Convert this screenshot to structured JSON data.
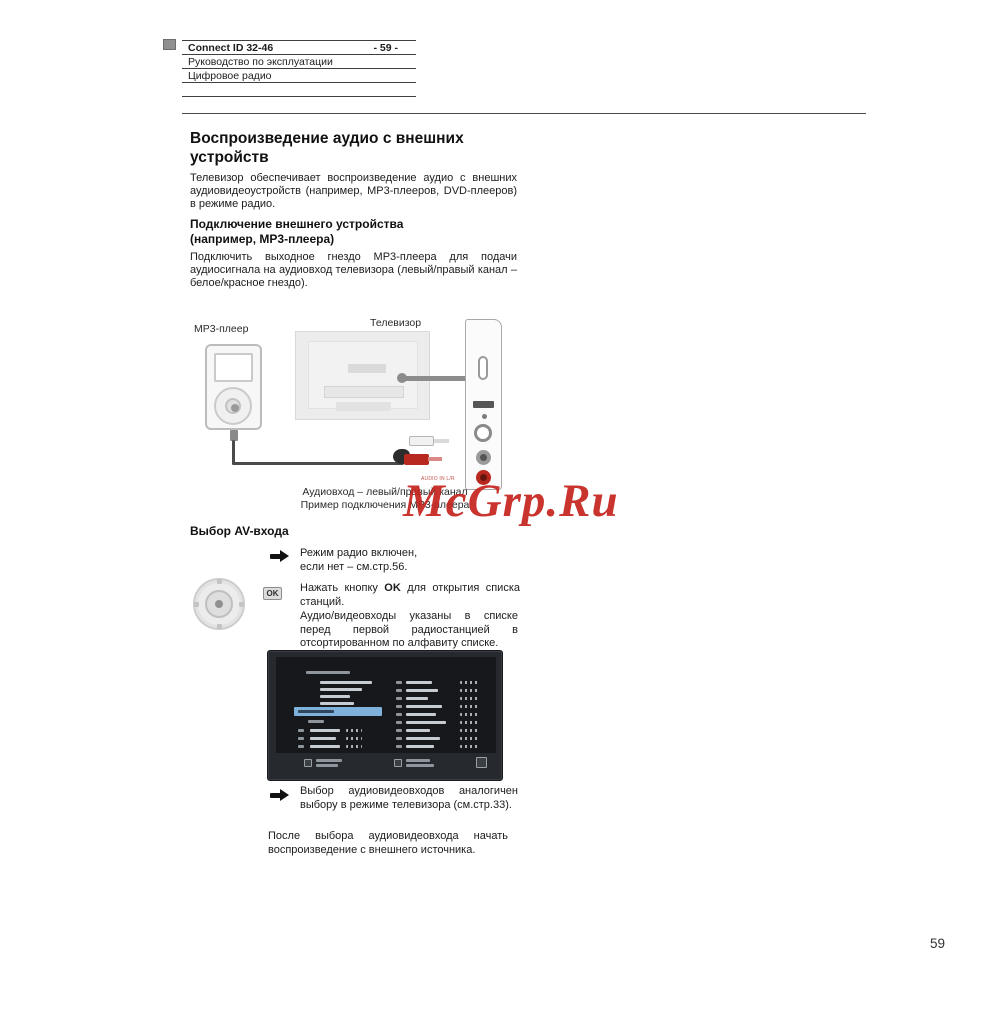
{
  "header": {
    "product": "Connect ID 32-46",
    "page_marker": "- 59 -",
    "manual": "Руководство по эксплуатации",
    "section": "Цифровое радио"
  },
  "article": {
    "title": "Воспроизведение аудио с внешних устройств",
    "intro": "Телевизор обеспечивает воспроизведение аудио с внешних аудиовидеоустройств (например, MP3-плееров, DVD-плееров) в режиме радио.",
    "connect_heading_1": "Подключение внешнего устройства",
    "connect_heading_2": "(например, MP3-плеера)",
    "connect_body": "Подключить выходное гнездо MP3-плеера для подачи аудиосигнала на аудиовход телевизора (левый/правый канал – белое/красное гнездо)."
  },
  "diagram": {
    "mp3_label": "MP3-плеер",
    "tv_label": "Телевизор",
    "jack_label": "AUDIO IN L/R",
    "caption_1": "Аудиовход – левый/правый канал",
    "caption_2": "Пример подключения MP3-плеера"
  },
  "watermark": "McGrp.Ru",
  "av": {
    "heading": "Выбор AV-входа",
    "note1_line1": "Режим радио включен,",
    "note1_line2": "если нет – см.стр.56.",
    "ok_icon_label": "OK",
    "step_pre": "Нажать кнопку ",
    "step_key": "OK",
    "step_post": " для открытия списка станций.",
    "list_info": "Аудио/видеовходы указаны в списке перед первой радиостанцией в отсортированном по алфавиту списке.",
    "note2": "Выбор аудиовидеовходов аналогичен выбору в режиме телевизора (см.стр.33).",
    "closing": "После выбора аудиовидеовхода начать воспроизведение с внешнего источника."
  },
  "footer": {
    "page_number": "59"
  },
  "colors": {
    "watermark_red": "#c6231d",
    "highlight_blue": "#7fb2da",
    "jack_red": "#b8281e"
  }
}
